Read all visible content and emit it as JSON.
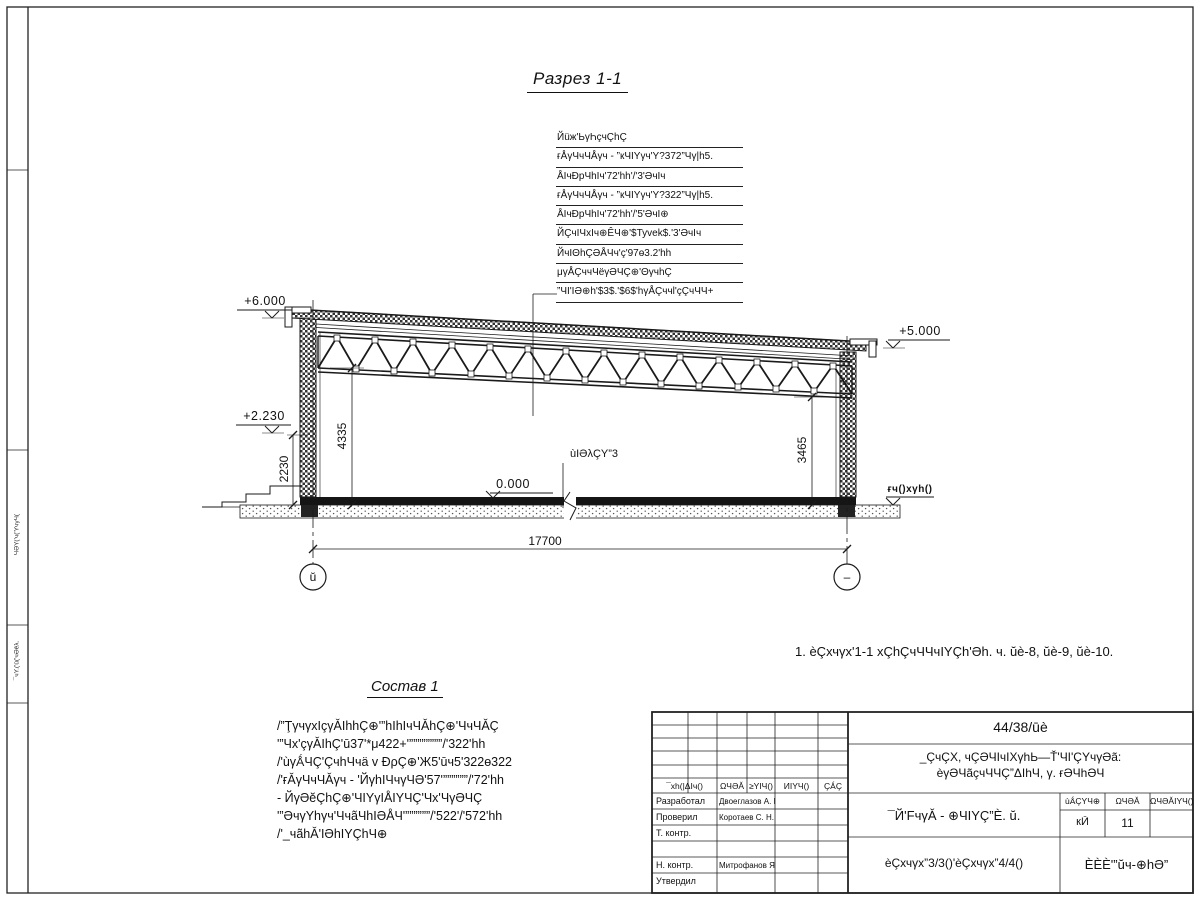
{
  "sheet": {
    "title": "Разрез 1-1",
    "note": "1. èÇхчγх'1-1 хÇhÇчЧЧчIYÇh'Əh. ч. ŭè-8, ŭè-9, ŭè-10."
  },
  "callout": {
    "title": "Йüж'ЬγҺçчÇhÇ",
    "items": [
      "ғÅγЧчЧÅγч - ”кЧIYγч'Y?372”Чγ|h5.",
      "ÅIчĐрЧhIч'72'hh'/'3'ƏчIч",
      "ғÅγЧчЧÅγч - ”кЧIYγч'Y?322”Чγ|h5.",
      "ÅIчĐрЧhIч'72'hh'/'5'ƏчI⊕",
      "ЙÇчIЧхIч⊕ÊЧ⊕'$Tyvek$.'3'ƏчIч",
      "ЙчIΘhÇƏÅЧч'ç'97ө3.2'hh",
      "μγÅÇччЧёγƏЧÇ⊕'ΘγчhÇ",
      "”ЧI'IƏ⊕h'$3$.'$6$'hγÅÇччl'çÇчЧЧ+"
    ]
  },
  "levels": {
    "l6000": "+6.000",
    "l5000": "+5.000",
    "l2230": "+2.230",
    "l0": "0.000",
    "ground_label": "ғч()хγh()"
  },
  "dims": {
    "span": "17700",
    "left_inner": "2230",
    "left_truss": "4335",
    "right_truss": "3465"
  },
  "floor_label": "ùIƏλÇY”3",
  "axes": {
    "left": "ŭ",
    "right": "–"
  },
  "sostav": {
    "title": "Состав 1",
    "lines": [
      "/”ŢγчγхIçγǍIhhÇ⊕'”hIhIчЧǍhÇ⊕'ЧчЧǍÇ",
      "'”Чх'çγǍIhÇ'ū37'*μ422+'””””””””/'322'hh",
      "/'ùγǺЧÇ'ÇчhЧчä v ĐρÇ⊕'Ж5'ūч5'322ө322",
      "/'ғǍγЧчЧǍγч - 'ЙγhIЧчγЧƏ'57'””””””/'72'hh",
      "- ЙγƏĕÇhÇ⊕'ЧIYγIÅIYЧÇ'Чх'ЧγƏЧÇ",
      "'”ƏчγYhγч'ЧчãЧhIƏÅЧ'””””””/'522'/'572'hh",
      "/'_чãhǍ'IƏhIYÇhЧ⊕"
    ]
  },
  "titleblock": {
    "doc_number": "44/38/ūè",
    "project_line1": "_ÇчÇХ, чÇƏЧIчIХγhЬ—Ť'ЧI'ÇYчγƏã:",
    "project_line2": "èγƏЧãçчЧЧÇ”ΔIhЧ, γ. ғƏЧhƏЧ",
    "header": [
      "¯хh(|ΔIч()",
      "ΩЧƏǍ",
      "≥YIЧ()",
      "ИIYЧ()",
      "ÇǺÇ"
    ],
    "rows": [
      {
        "label": "Разработал",
        "name": "Двоеглазов А. В."
      },
      {
        "label": "Проверил",
        "name": "Коротаев С. Н."
      },
      {
        "label": "Т. контр.",
        "name": ""
      },
      {
        "label": "",
        "name": ""
      },
      {
        "label": "Н. контр.",
        "name": "Митрофанов Я. А."
      },
      {
        "label": "Утвердил",
        "name": ""
      }
    ],
    "sheet_title": "¯Й'FчγǍ - ⊕ЧIYÇ”È. ŭ.",
    "sheet_subtitle": "èÇхчγх”3/3()'èÇхчγх”4/4()",
    "stage": {
      "headers": [
        "ùǺÇYЧ⊕",
        "ΩЧƏǍ",
        "ΩЧƏǍIYЧ()"
      ],
      "values": [
        "кЙ",
        "11",
        ""
      ]
    },
    "company": "ÈÈÈ'”ŭч-⊕hƏ”"
  },
  "margin": {
    "v1": "ЧƏY('ч('YчγЧ(",
    "v2": "¯чY.('ŭ('чƏĕλ."
  },
  "colors": {
    "ink": "#111111",
    "paper": "#ffffff"
  }
}
